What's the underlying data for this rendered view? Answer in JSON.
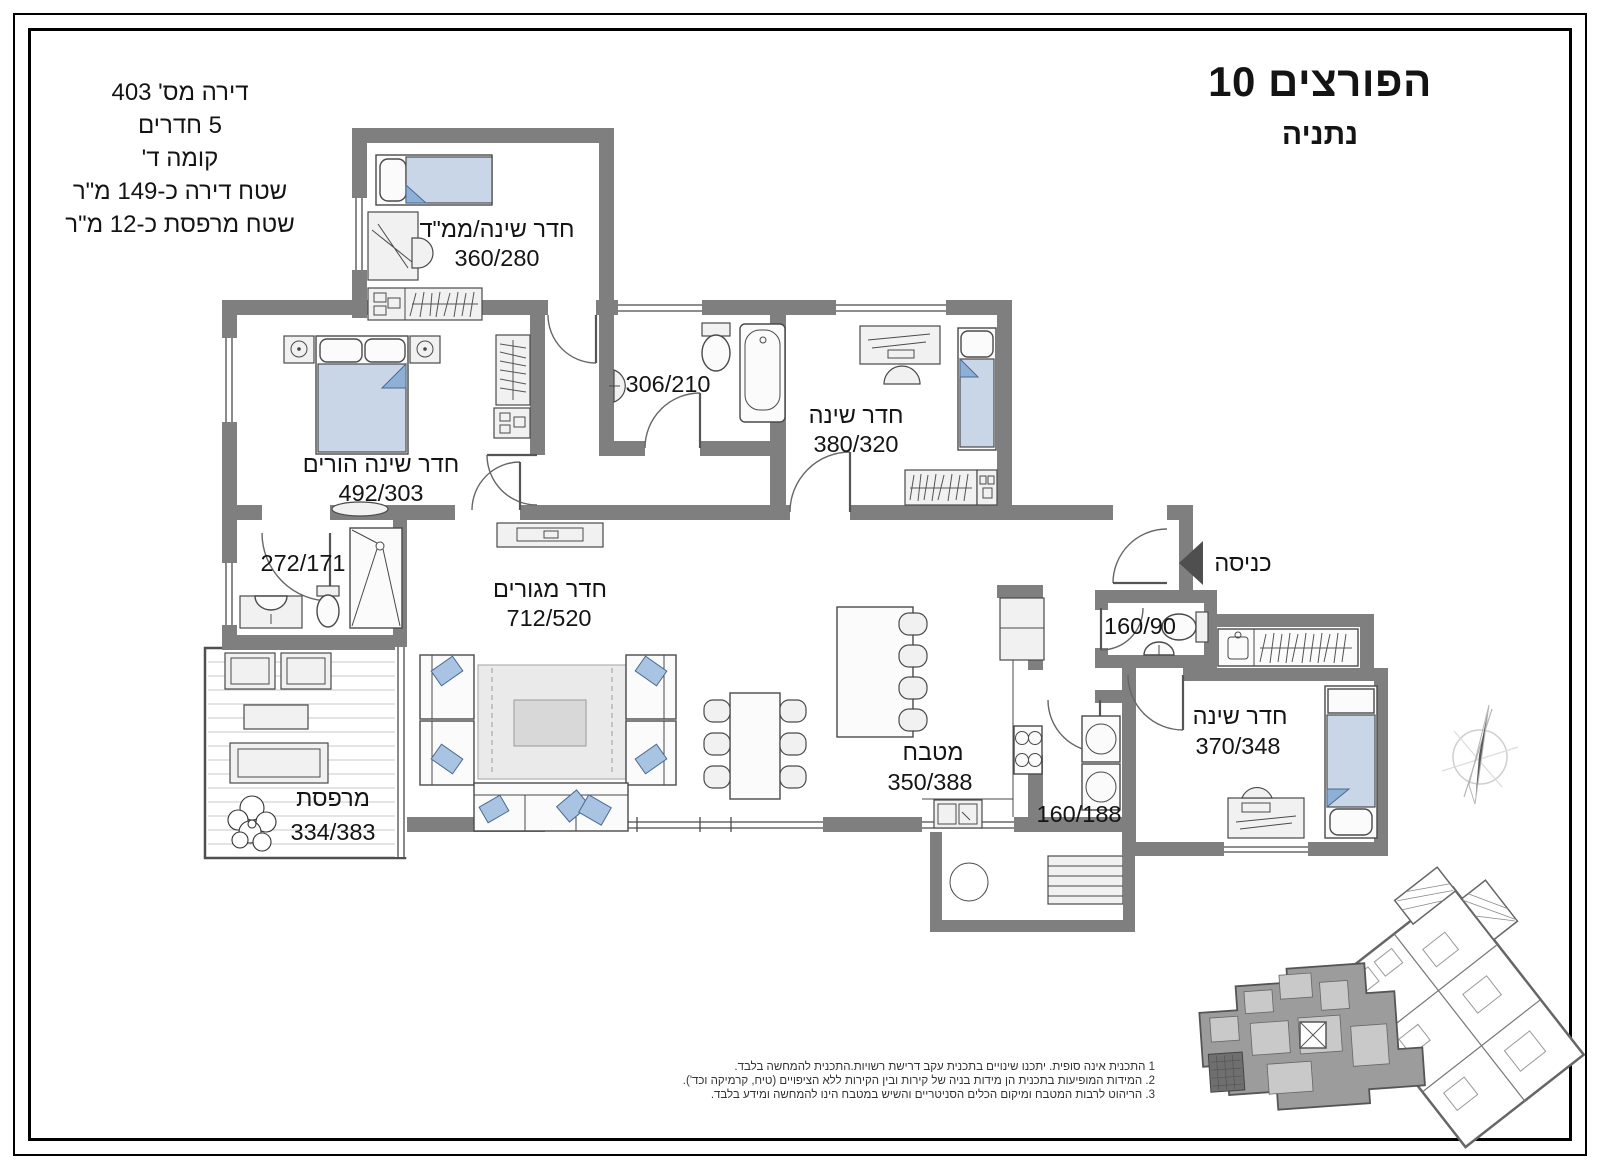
{
  "header": {
    "street": "הפורצים 10",
    "city": "נתניה"
  },
  "apartment_info": {
    "lines": [
      "דירה מס' 403",
      "5 חדרים",
      "קומה ד'",
      "שטח דירה כ-149 מ\"ר",
      "שטח מרפסת כ-12 מ\"ר"
    ]
  },
  "rooms": {
    "mamad": {
      "name": "חדר שינה/ממ\"ד",
      "dims": "360/280"
    },
    "parents": {
      "name": "חדר שינה הורים",
      "dims": "492/303"
    },
    "bath_main": {
      "dims": "306/210"
    },
    "bedroom2": {
      "name": "חדר שינה",
      "dims": "380/320"
    },
    "bath_shower": {
      "dims": "272/171"
    },
    "living": {
      "name": "חדר מגורים",
      "dims": "712/520"
    },
    "kitchen": {
      "name": "מטבח",
      "dims": "350/388"
    },
    "toilet": {
      "dims": "160/90"
    },
    "laundry": {
      "dims": "160/188"
    },
    "bedroom3": {
      "name": "חדר שינה",
      "dims": "370/348"
    },
    "balcony": {
      "name": "מרפסת",
      "dims": "334/383"
    }
  },
  "entrance_label": "כניסה",
  "notes": [
    "1 התכנית אינה סופית. יתכנו שינויים בתכנית עקב דרישת רשויות.התכנית להמחשה בלבד.",
    "2. המידות המופיעות בתכנית הן מידות בניה של קירות ובין הקירות ללא הציפויים (טיח, קרמיקה וכד').",
    "3. הריהוט לרבות המטבח ומיקום הכלים הסניטריים והשיש במטבח הינו להמחשה ומידע בלבד."
  ],
  "colors": {
    "wall": "#7f7f7f",
    "bed": "#c8d6e8",
    "cushion": "#a9c4e2",
    "text": "#141414"
  }
}
